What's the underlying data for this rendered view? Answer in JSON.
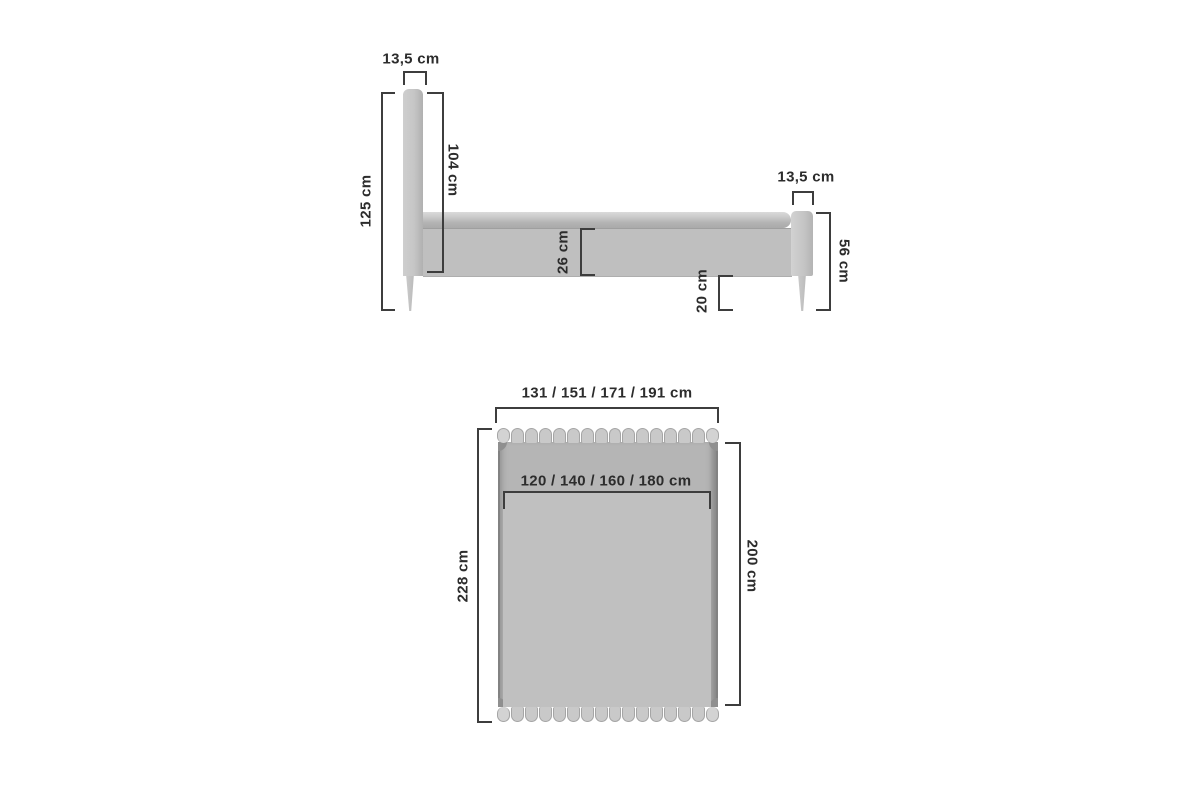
{
  "page": {
    "type": "furniture dimension diagram",
    "subject": "upholstered bed with slatted headboard and footboard",
    "background": "#ffffff",
    "units": "cm"
  },
  "side_view": {
    "headboard_width_label": "13,5 cm",
    "headboard_height_label": "125 cm",
    "headboard_front_height_label": "104 cm",
    "frame_height_label": "26 cm",
    "clearance_label": "20 cm",
    "footboard_width_label": "13,5 cm",
    "footboard_height_label": "56 cm"
  },
  "top_view": {
    "outer_width_label": "131 / 151 / 171 / 191 cm",
    "mattress_width_label": "120 / 140 / 160 / 180 cm",
    "outer_length_label": "228 cm",
    "mattress_length_label": "200 cm"
  },
  "dimensions_cm": {
    "headboard_thickness": 13.5,
    "headboard_total_height": 125,
    "headboard_height_above_frame_bottom": 104,
    "side_frame_height": 26,
    "floor_clearance": 20,
    "footboard_thickness": 13.5,
    "footboard_height": 56,
    "outer_widths": [
      131,
      151,
      171,
      191
    ],
    "mattress_widths": [
      120,
      140,
      160,
      180
    ],
    "outer_length": 228,
    "mattress_length": 200
  },
  "colors": {
    "dimension_line": "#3d3d3d",
    "label_text": "#2c2c2c",
    "fabric_light": "#cecece",
    "fabric_mid": "#bfbfbf",
    "fabric_dark": "#aaaaaa"
  }
}
